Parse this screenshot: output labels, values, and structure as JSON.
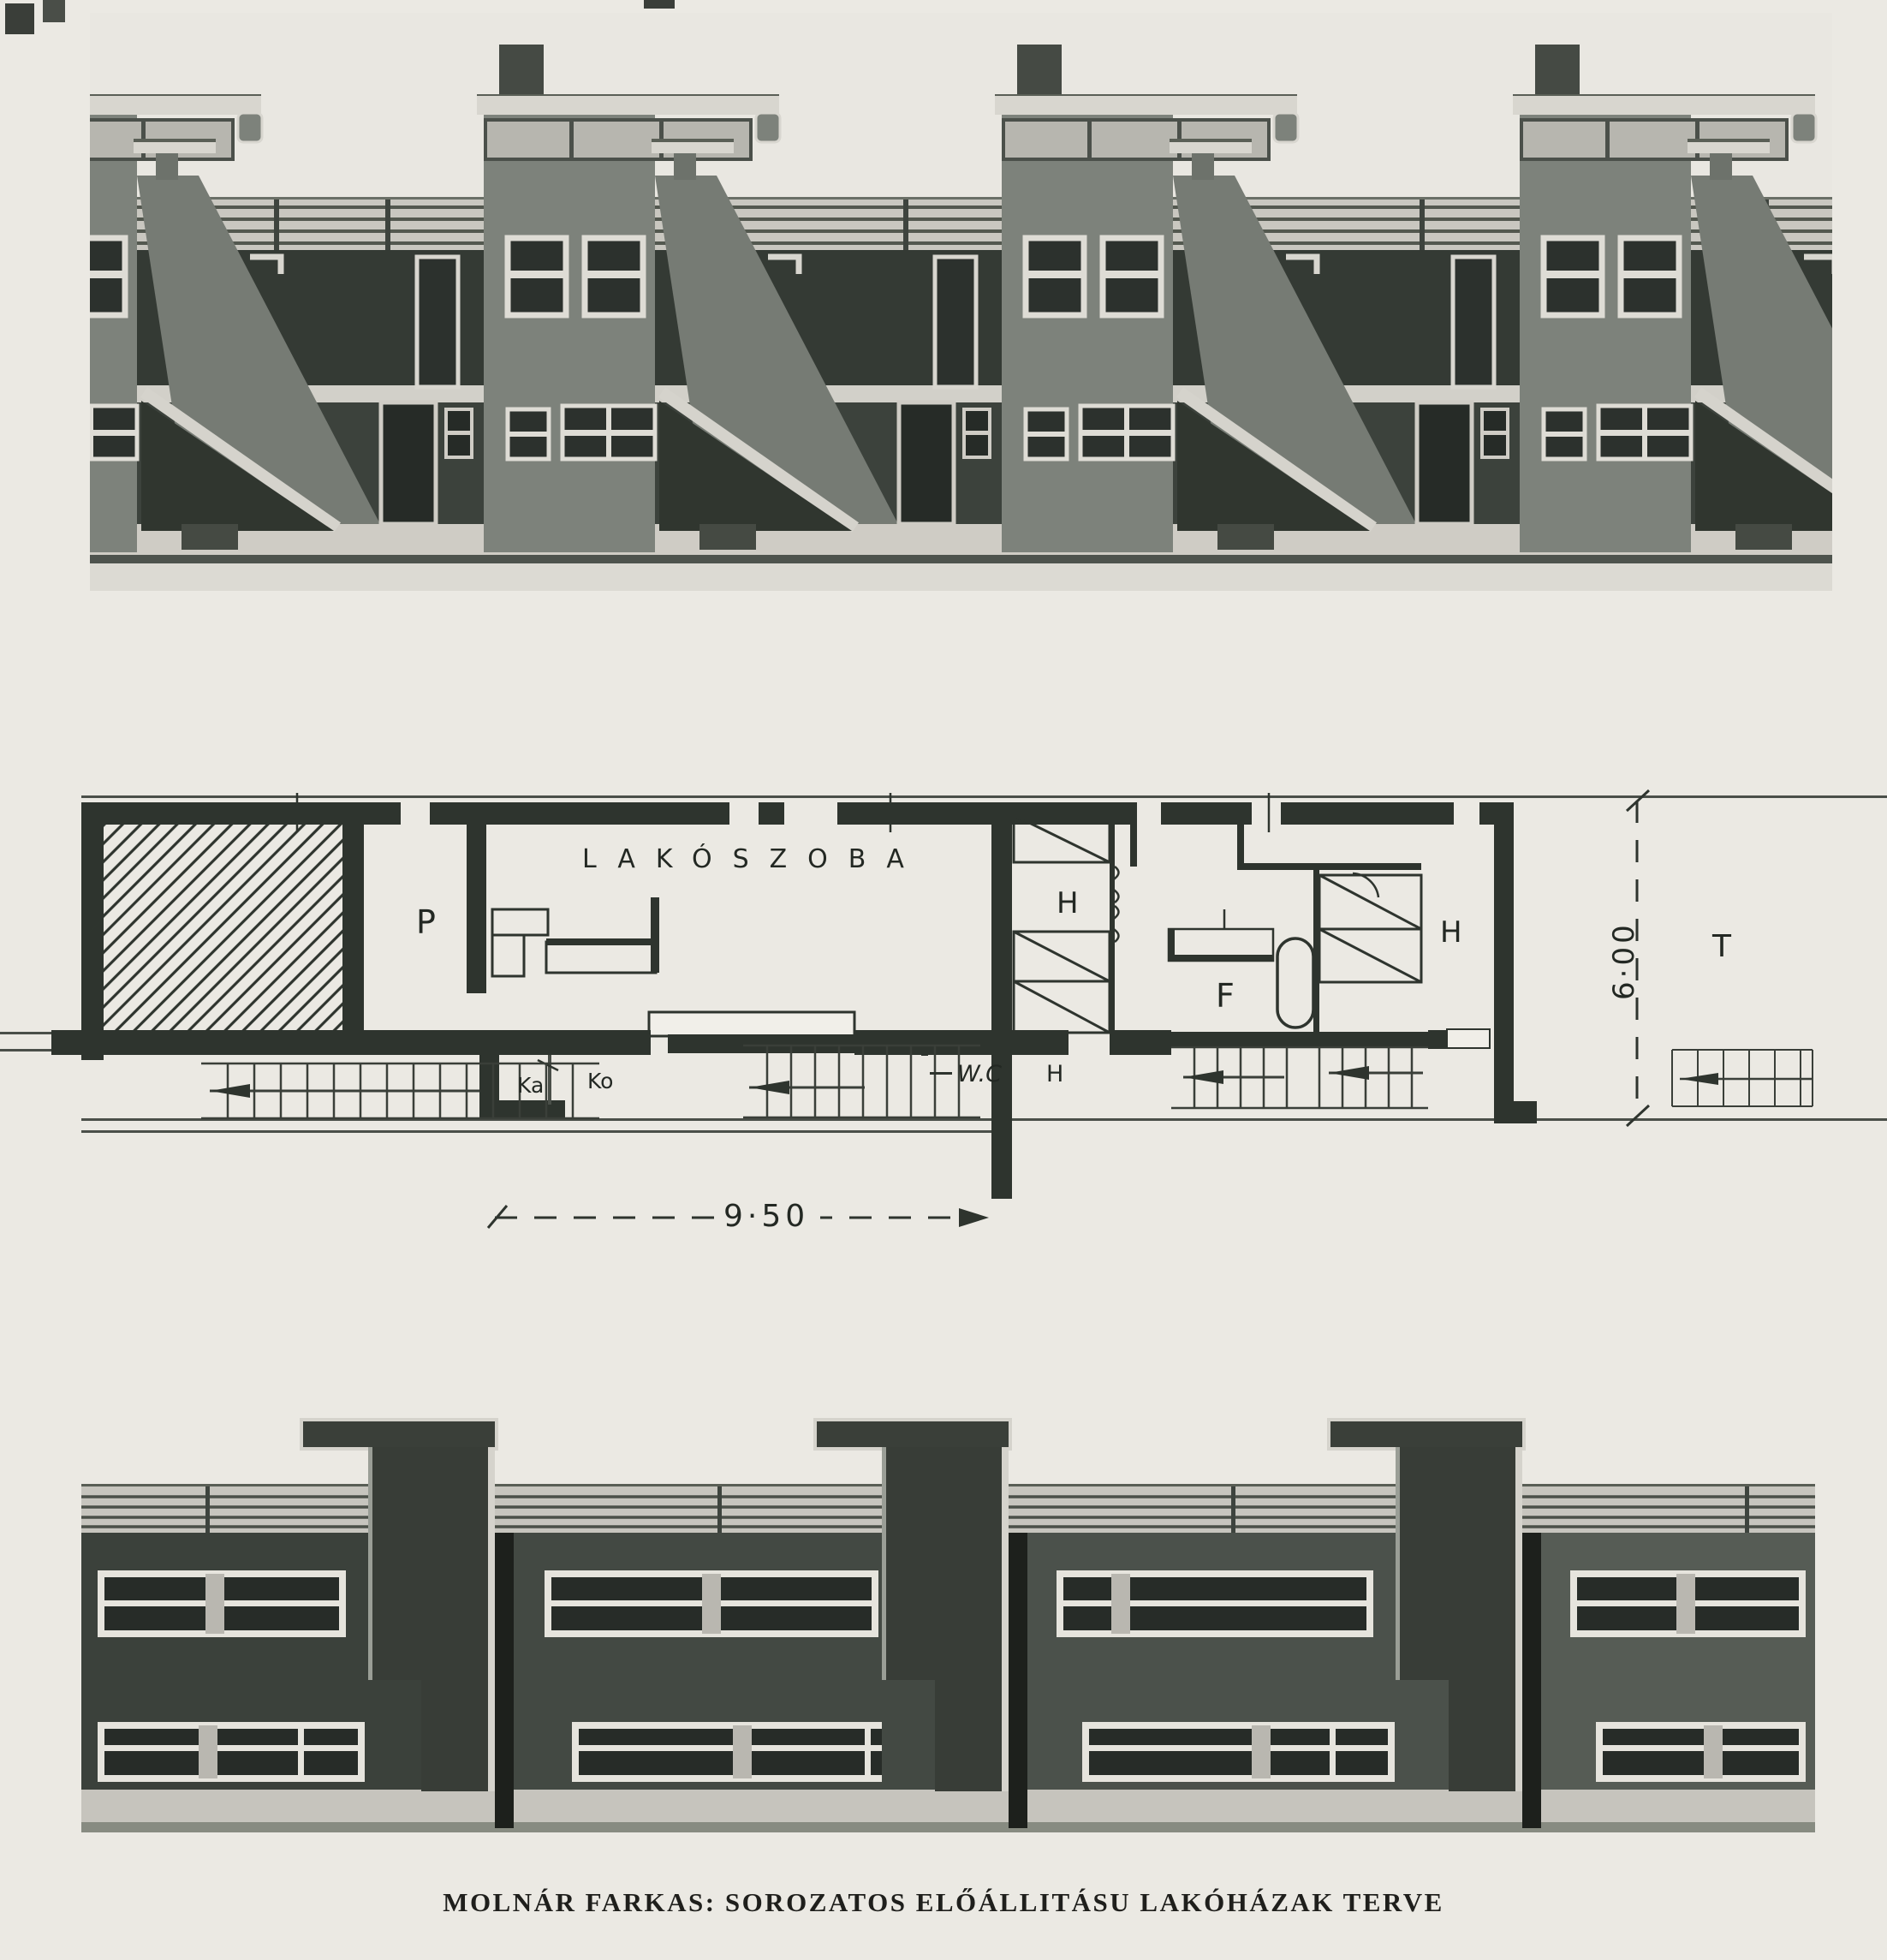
{
  "page": {
    "caption": "MOLNÁR FARKAS: SOROZATOS ELŐÁLLITÁSU LAKÓHÁZAK TERVE",
    "background_color": "#ebe9e3",
    "ink_color": "#2e342e"
  },
  "figures": {
    "top_elevation": {
      "description": "Rear elevation of stepped row houses with external diagonal stairs, roof terraces, railings and chimneys",
      "repeating_units": 3
    },
    "floor_plan": {
      "description": "Floor plan of serially produced dwelling units",
      "labels": {
        "living_room": "LAKÓSZOBA",
        "pantry": "P",
        "bedroom_left": "H",
        "bedroom_right": "H",
        "hall": "H",
        "bathroom": "F",
        "entry": "Ka",
        "kitchen": "Ko",
        "wc": "W.C",
        "terrace": "T"
      },
      "dimensions": {
        "width": "9·50",
        "depth": "6·00"
      }
    },
    "bottom_elevation": {
      "description": "Street facade with horizontal strip windows, stair towers and roof railing",
      "repeating_units": 4
    }
  },
  "colors": {
    "paper": "#ebe9e3",
    "wall_ink": "#2e342e",
    "elevation_mid_gray": "#7d827b",
    "elevation_dark": "#343a34",
    "window_frame_light": "#dedcd5",
    "window_pane_dark": "#2c312d",
    "facade_dark": "#3b413b",
    "ground_light": "#cfccc5"
  }
}
